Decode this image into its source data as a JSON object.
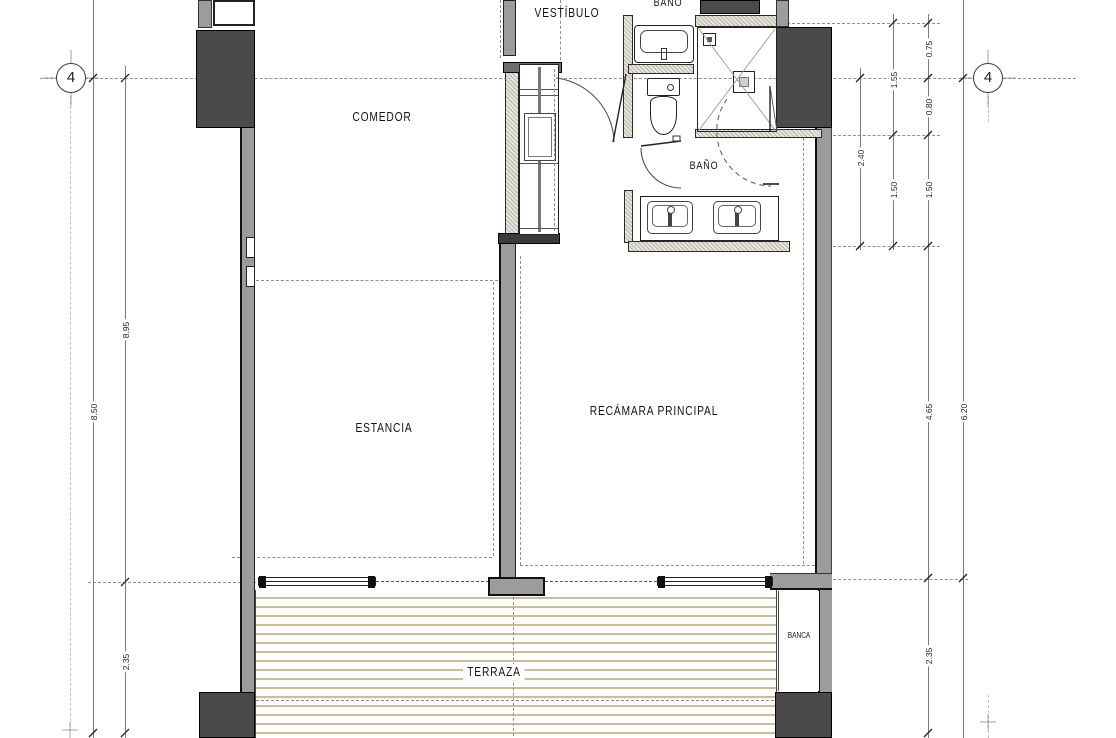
{
  "plan": {
    "rooms": {
      "vestibulo": "VESTÍBULO",
      "bano_top": "BAÑO",
      "comedor": "COMEDOR",
      "bano": "BAÑO",
      "estancia": "ESTANCIA",
      "recamara": "RECÁMARA PRINCIPAL",
      "terraza": "TERRAZA",
      "banca": "BANCA"
    },
    "grid": {
      "left": "4",
      "right": "4"
    },
    "dims": {
      "d_left_total": "8.50",
      "d_left_upper": "8.95",
      "d_left_terrace": "2.35",
      "d_bath_total": "2.40",
      "d_bath_upper": "1.55",
      "d_bath_lower_a": "1.50",
      "d_top_a": "0.75",
      "d_top_b": "0.80",
      "d_bath_lower_b": "1.50",
      "d_bedroom": "4.65",
      "d_right_total": "6.20",
      "d_terrace": "2.35"
    },
    "fixtures": {
      "sink_top": "sink",
      "toilet": "toilet",
      "shower": "shower",
      "sink_double": "double-sink-counter",
      "closet": "closet-shelves",
      "sliding_doors": "sliding-glass-doors",
      "deck": "wood-deck",
      "bench": "bench-niche"
    },
    "colors": {
      "wall_dark": "#4a4a4a",
      "wall_gray": "#9c9c9c",
      "wall_hatch": "#e9e6df",
      "deck_stripe": "#cdbd96",
      "line": "#1c1c1c",
      "dash": "#8f8f8f"
    }
  }
}
